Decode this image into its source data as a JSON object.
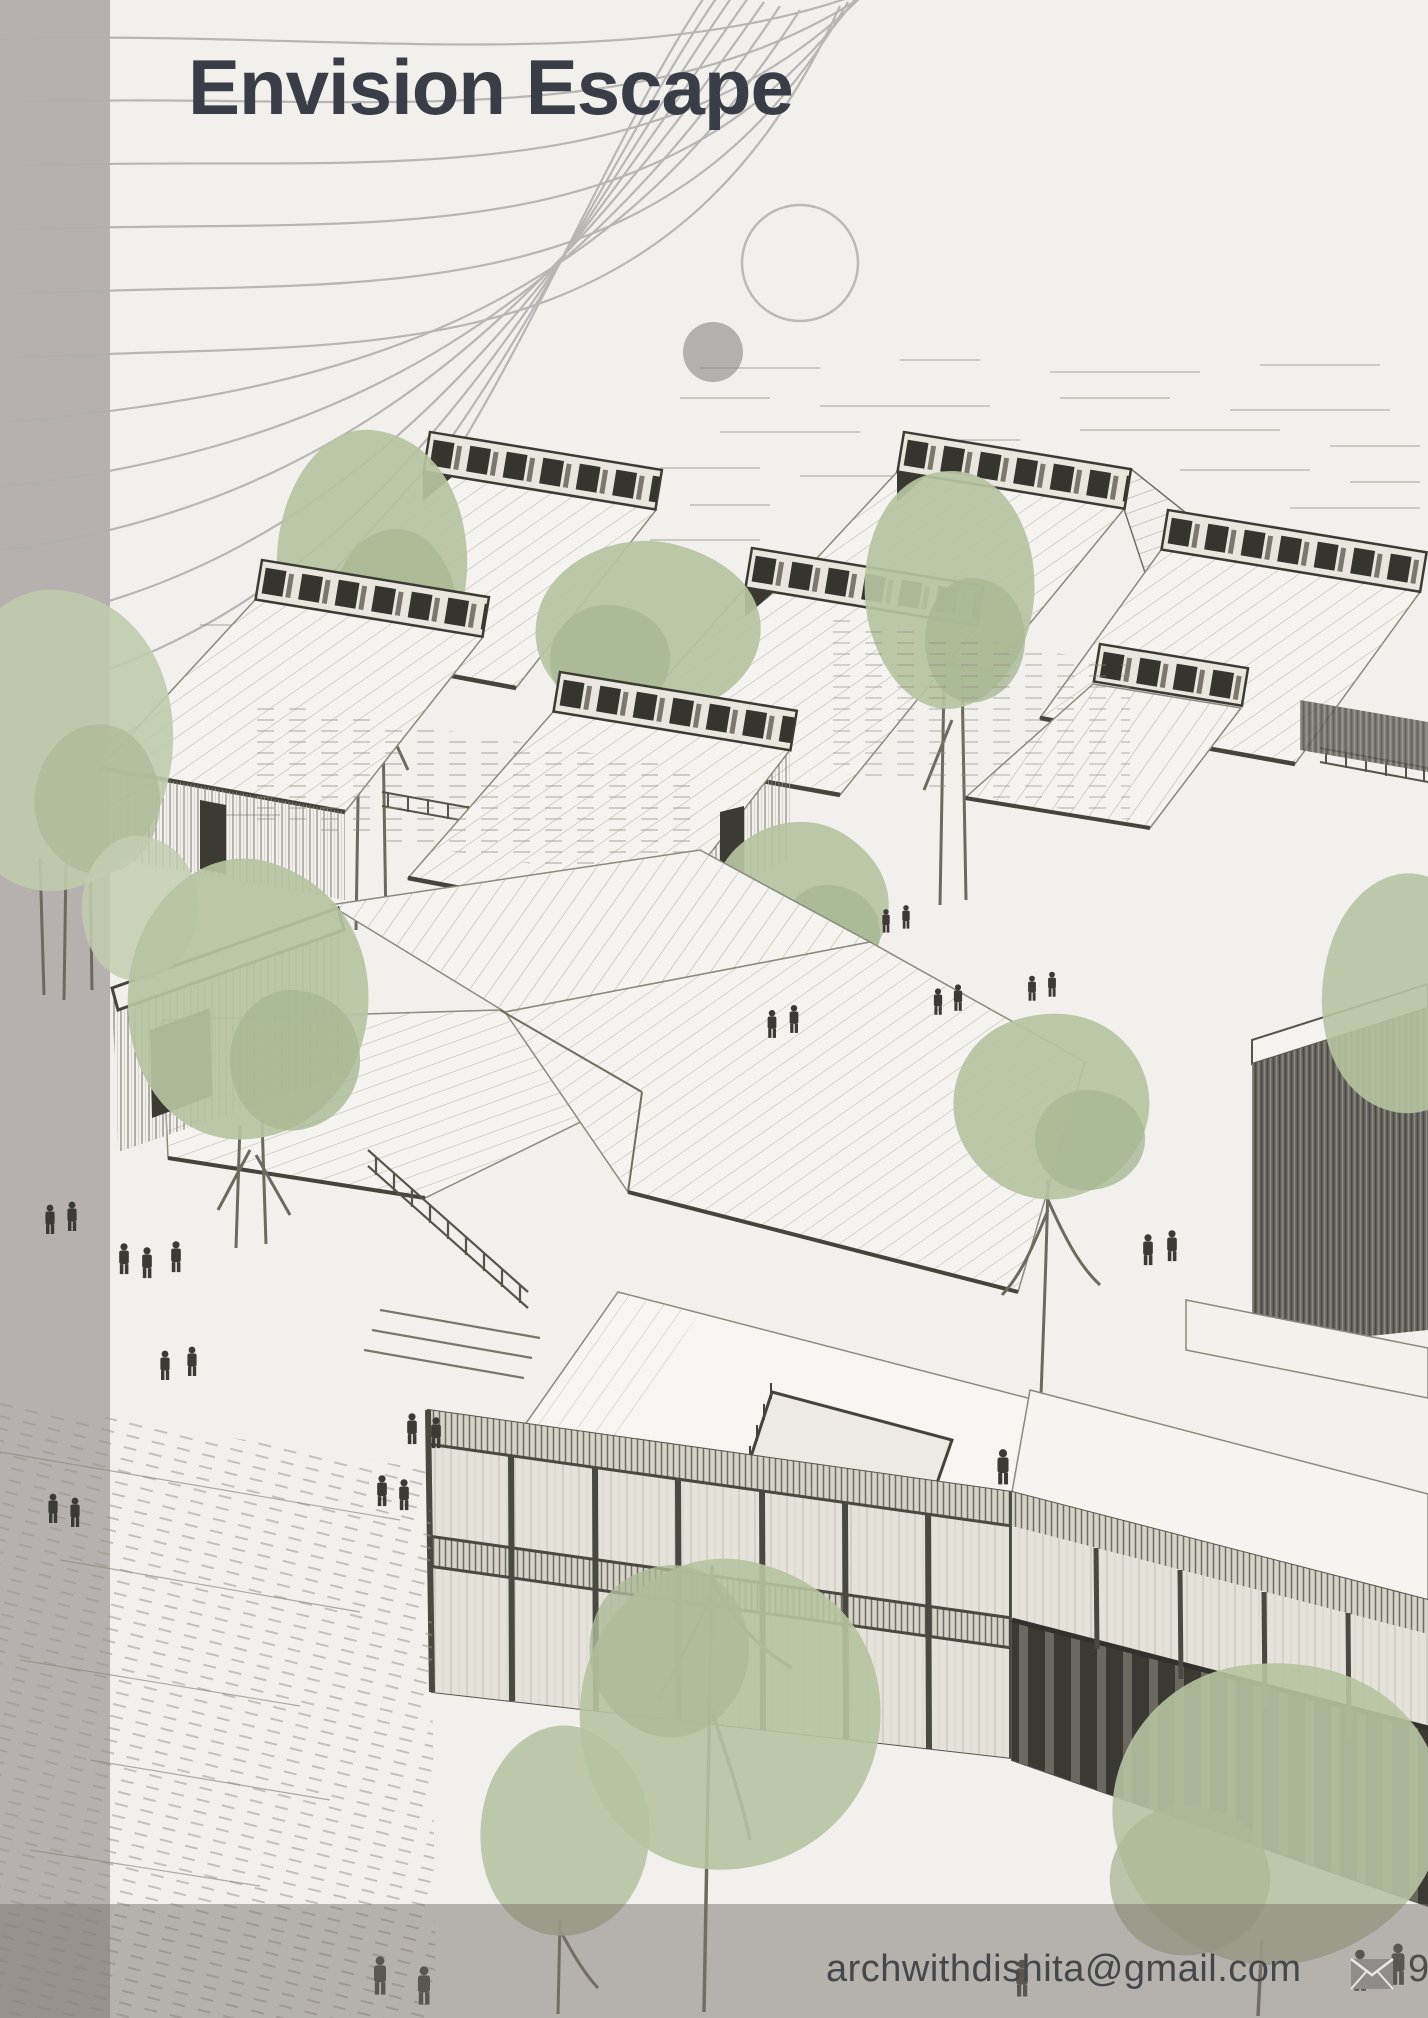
{
  "page": {
    "title": "Envision Escape"
  },
  "footer": {
    "email": "archwithdishita@gmail.com",
    "phone_partial": "9",
    "icons": [
      "envelope-icon"
    ]
  },
  "colors": {
    "paper": "#f1f0ed",
    "sidebar_gray": "#b6b1ae",
    "footer_overlay_gray": "#aba49f",
    "title_text": "#3a3d45",
    "email_text": "#44484b",
    "arc_gray": "#b1b0ae",
    "ink_dark": "#3c3b33",
    "ink_light": "#a5a295",
    "tree_green": "#b6c3a1"
  }
}
